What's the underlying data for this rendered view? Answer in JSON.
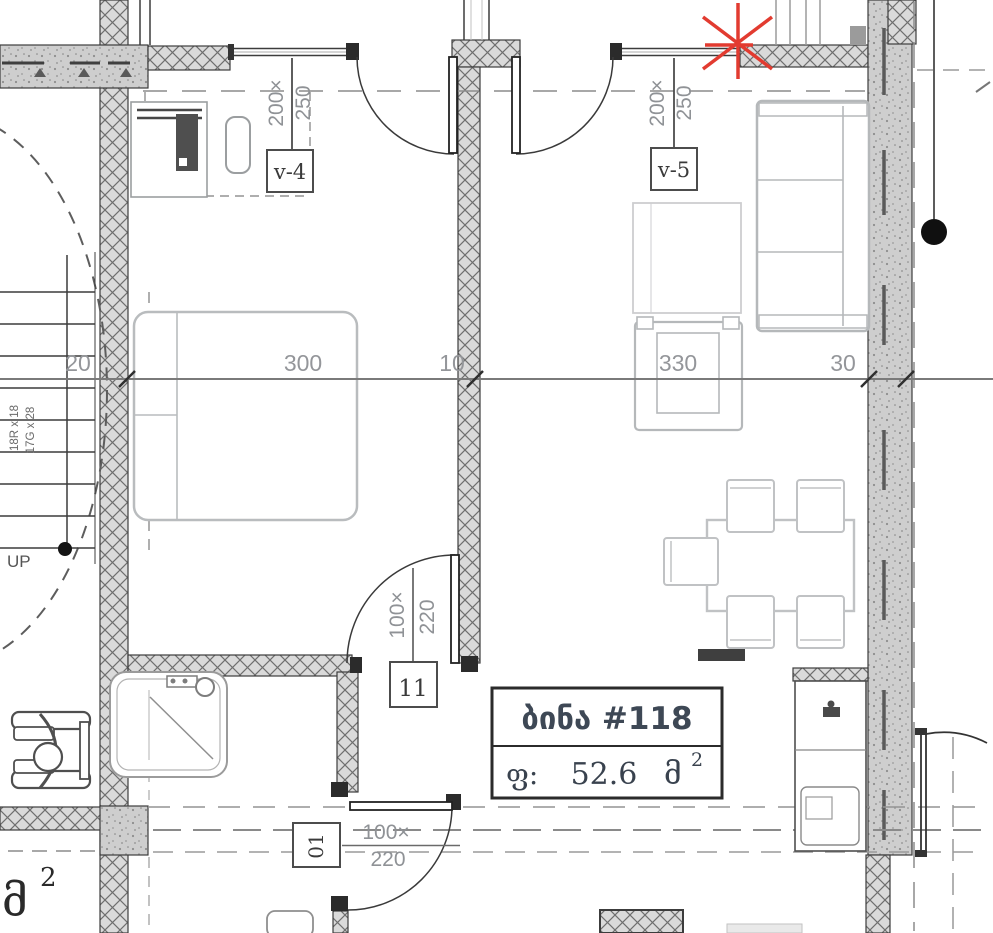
{
  "plan": {
    "apartment": {
      "title": "ბინა #118",
      "area_prefix": "ფ:",
      "area_value": "52.6",
      "area_unit": "მ",
      "area_sup": "2"
    },
    "dims": {
      "d20": "20",
      "d300": "300",
      "d10": "10",
      "d330": "330",
      "d30": "30"
    },
    "windows": {
      "v4": {
        "tag": "v-4",
        "w": "200×",
        "h": "250"
      },
      "v5": {
        "tag": "v-5",
        "w": "200×",
        "h": "250"
      }
    },
    "doors": {
      "d11": {
        "tag": "11",
        "w": "100×",
        "h": "220"
      },
      "d01": {
        "tag": "01",
        "w": "100×",
        "h": "220"
      }
    },
    "stairs": {
      "up": "UP",
      "note1": "18R x 18",
      "note2": "17G x 28"
    },
    "corner": {
      "unit": "მ",
      "sup": "2"
    },
    "colors": {
      "hatch_bg": "#dadada",
      "hatch_line": "#6f6f6f",
      "concrete_bg": "#cecece",
      "line_dark": "#3c3c3c",
      "furniture_gray": "#b9bcbe",
      "dim_text": "#94969a",
      "red_mark": "#e23b30"
    }
  }
}
